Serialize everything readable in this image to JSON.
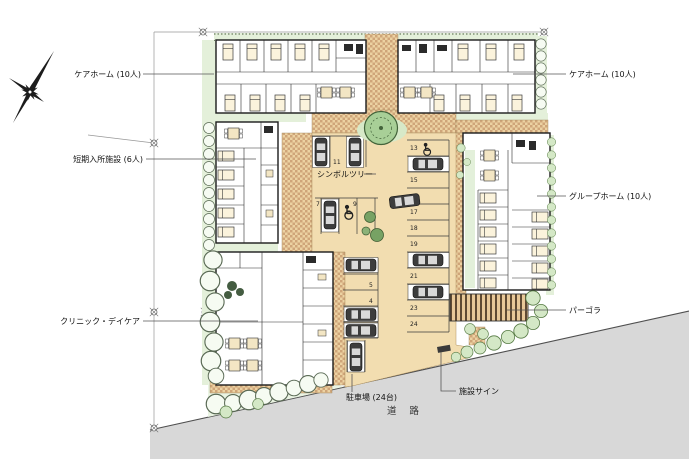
{
  "labels": {
    "care_home_left": "ケアホーム (10人)",
    "care_home_right": "ケアホーム (10人)",
    "short_stay": "短期入所施設 (6人)",
    "group_home": "グループホーム (10人)",
    "clinic_daycare": "クリニック・デイケア",
    "pergola": "パーゴラ",
    "symbol_tree": "シンボルツリー",
    "parking": "駐車場 (24台)",
    "facility_sign": "施設サイン",
    "road": "道 路"
  },
  "parking": {
    "capacity_label": "24台",
    "right_column_numbers": [
      "13",
      "15",
      "17",
      "18",
      "19",
      "21",
      "23",
      "24"
    ],
    "left_column_numbers": [
      "11",
      "7",
      "9",
      "5",
      "4"
    ]
  },
  "colors": {
    "paving_tan": "#f2ddb0",
    "hatch_brown": "#cfa579",
    "landscape_green": "#e4f0da",
    "symbol_tree_green": "#a8cf97",
    "road_gray": "#d8d8d8"
  }
}
